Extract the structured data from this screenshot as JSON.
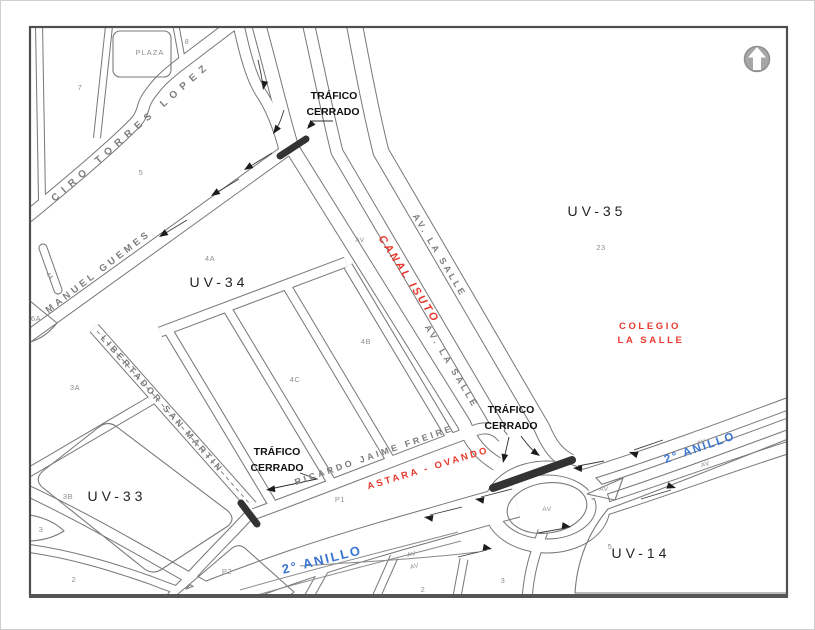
{
  "colors": {
    "accent_red": "#e8392e",
    "accent_blue": "#3b74d1",
    "road_gray": "#777777",
    "street_text_gray": "#7d7d7d",
    "number_gray": "#8f8f8f",
    "closure_bar": "#333333",
    "zone_text": "#242424"
  },
  "zones": [
    {
      "label": "UV-35"
    },
    {
      "label": "UV-34"
    },
    {
      "label": "UV-33"
    },
    {
      "label": "UV-14"
    }
  ],
  "streets": [
    {
      "name": "CIRO TORRES LOPEZ"
    },
    {
      "name": "MANUEL GUEMES"
    },
    {
      "name": "LIBERTADOR SAN MARTIN"
    },
    {
      "name": "RICARDO JAIME FREIRE"
    },
    {
      "name": "AV. LA SALLE"
    },
    {
      "name": "AV. LA SALLE"
    },
    {
      "name": "2° ANILLO"
    },
    {
      "name": "2° ANILLO"
    }
  ],
  "landmarks": {
    "plaza": "PLAZA",
    "canal": "CANAL ISUTO",
    "colegio_line1": "COLEGIO",
    "colegio_line2": "LA SALLE",
    "astara": "ASTARA - OVANDO"
  },
  "closures": {
    "line1": "TRÁFICO",
    "line2": "CERRADO",
    "count": 3
  },
  "block_numbers": [
    {
      "t": "7"
    },
    {
      "t": "8"
    },
    {
      "t": "5"
    },
    {
      "t": "23"
    },
    {
      "t": "4A"
    },
    {
      "t": "4B"
    },
    {
      "t": "4C"
    },
    {
      "t": "3A"
    },
    {
      "t": "3B"
    },
    {
      "t": "6A"
    },
    {
      "t": "44"
    },
    {
      "t": "P1"
    },
    {
      "t": "P2"
    },
    {
      "t": "2"
    },
    {
      "t": "3"
    },
    {
      "t": "2"
    },
    {
      "t": "3"
    },
    {
      "t": "5"
    }
  ],
  "av_labels": [
    "AV",
    "AV",
    "AV",
    "AV",
    "AV",
    "AV",
    "AV"
  ],
  "compass": {
    "icon": "north-arrow"
  }
}
